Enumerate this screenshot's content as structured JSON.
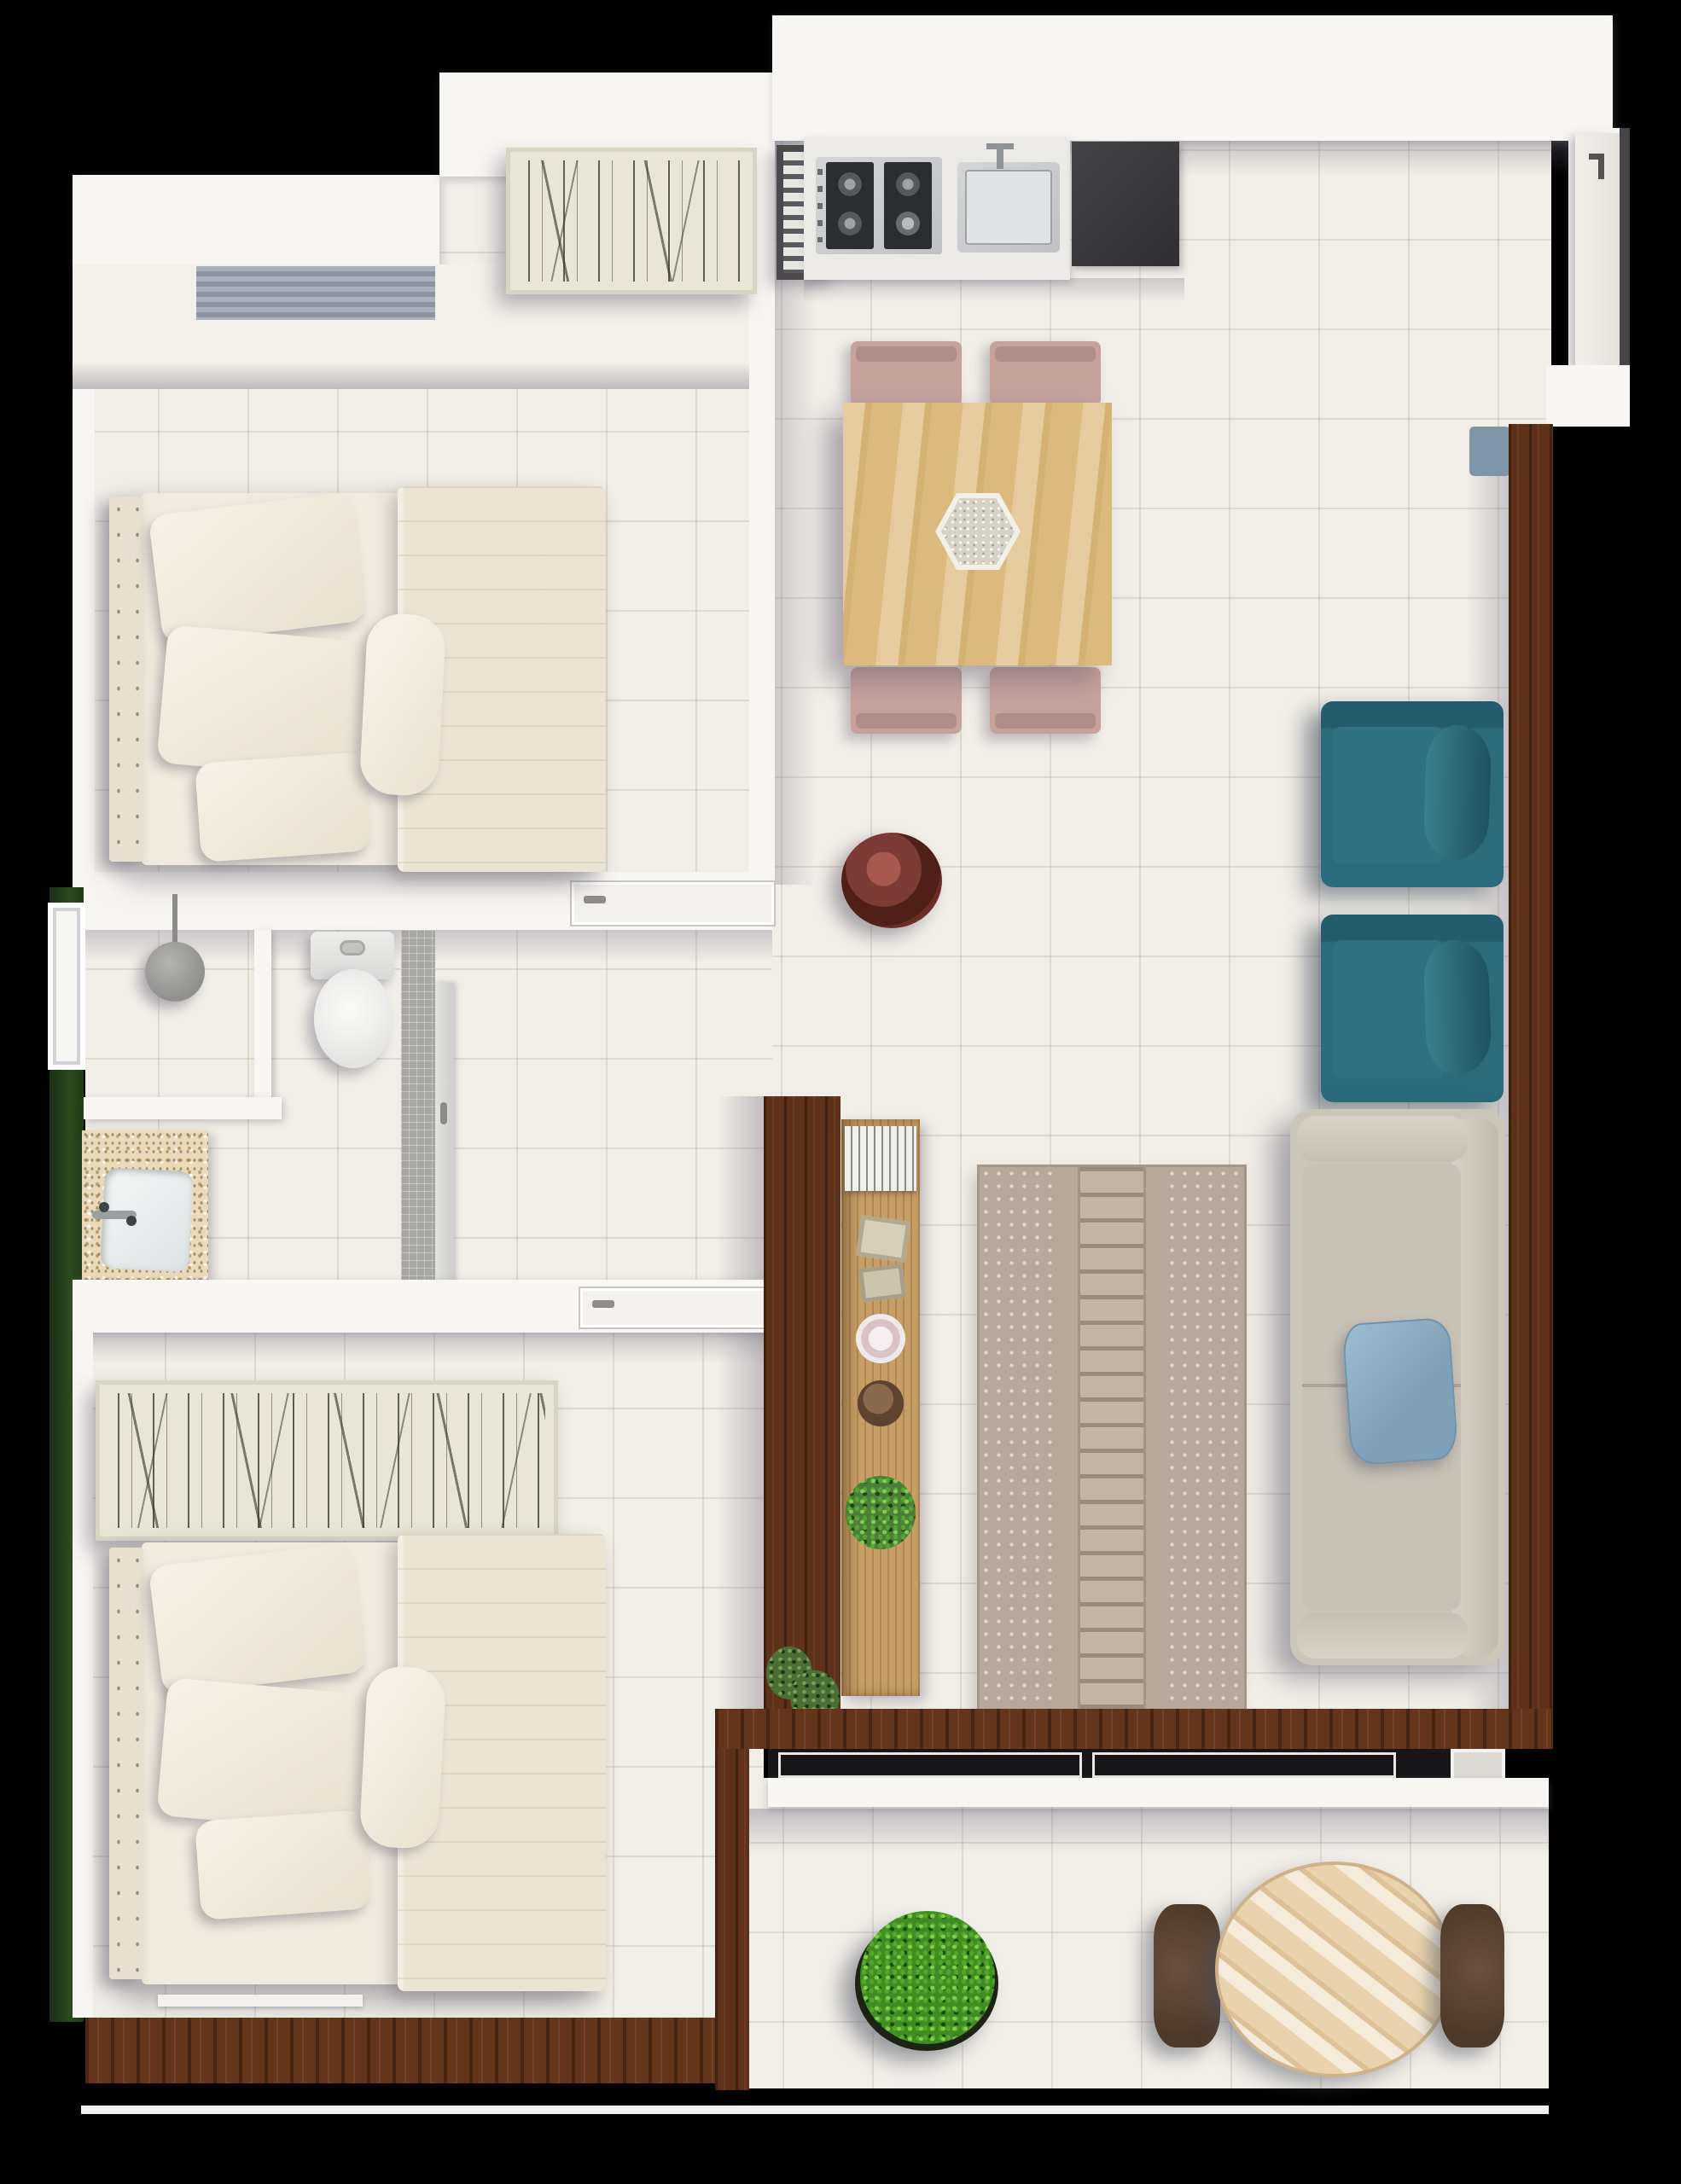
{
  "scene": {
    "title": "Apartment floor plan — top-down 3D render",
    "type": "floor-plan",
    "style": "rendered perspective top view, black background"
  },
  "palette": {
    "background": "#000000",
    "floor_tile": "#f1ede7",
    "wall_white": "#f8f6f2",
    "wood_dark": "#5e3118",
    "wood_table": "#dcba7e",
    "wood_sideboard": "#c79e66",
    "teal_armchair": "#2b6b7b",
    "sofa_beige": "#ccc5b9",
    "pillow_blue": "#8fb0c6",
    "rug_taupe": "#b6a99c",
    "chair_mauve": "#c7a29d",
    "counter_dark": "#3a3a3c",
    "stainless_steel": "#c9cbcd",
    "granite_beige": "#e9dbb9",
    "bowl_red": "#7d3b35",
    "plant_green": "#58a832",
    "hedge_green": "#2e4a1f",
    "bedding_cream": "#efe9dd"
  },
  "rooms": [
    {
      "id": "bedroom-1",
      "name": "Bedroom 1",
      "furniture": [
        "double bed with pillows and duvet",
        "headboard",
        "wardrobe band",
        "window blinds",
        "bamboo wall art",
        "sliding door sill"
      ]
    },
    {
      "id": "bathroom",
      "name": "Bathroom",
      "furniture": [
        "shower head",
        "partition wall",
        "toilet",
        "granite vanity with basin",
        "tiled pocket-door strip"
      ]
    },
    {
      "id": "bedroom-2",
      "name": "Bedroom 2",
      "furniture": [
        "double bed with pillows and duvet",
        "long bamboo wall art",
        "window sill",
        "wood deck band"
      ]
    },
    {
      "id": "kitchen",
      "name": "Kitchen / Dining",
      "furniture": [
        "4-burner cooktop",
        "stainless sink",
        "dark counter slab",
        "wood dining table",
        "hexagonal centerpiece",
        "4 mauve chairs",
        "red decor bowl",
        "wall vent frame"
      ]
    },
    {
      "id": "living",
      "name": "Living Room",
      "furniture": [
        "beige sofa with blue pillow",
        "2 teal armchairs",
        "patterned rug",
        "wood sideboard with decor",
        "planter wall strip"
      ]
    },
    {
      "id": "balcony",
      "name": "Balcony",
      "furniture": [
        "sliding glass track",
        "round wood table",
        "2 brown chairs",
        "potted plant"
      ]
    },
    {
      "id": "entry",
      "name": "Entry",
      "furniture": [
        "open door leaf",
        "door handle",
        "doormat"
      ]
    }
  ],
  "counts": {
    "bedrooms": 2,
    "armchairs": 2,
    "dining_chairs": 4,
    "balcony_chairs": 2
  }
}
